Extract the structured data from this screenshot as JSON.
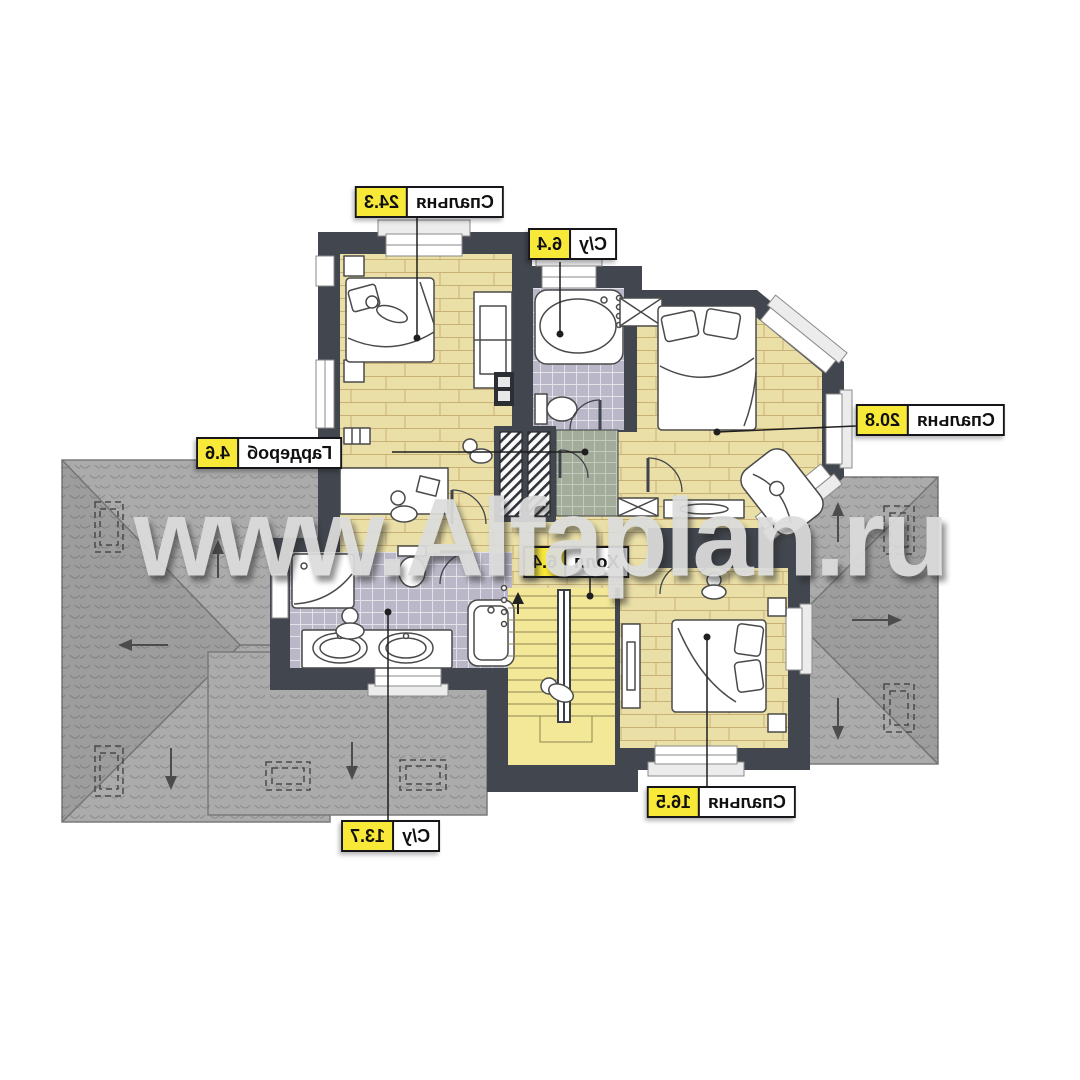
{
  "watermark": {
    "text": "www.Alfaplan.ru"
  },
  "floor_plan": {
    "note": "second floor plan, mirrored room labels",
    "labels": [
      {
        "room": "Спальня",
        "area": "24.3"
      },
      {
        "room": "С/у",
        "area": "6.4"
      },
      {
        "room": "Спальня",
        "area": "20.8"
      },
      {
        "room": "Гардероб",
        "area": "4.6"
      },
      {
        "room": "Холл",
        "area": "6.4"
      },
      {
        "room": "С/у",
        "area": "13.7"
      },
      {
        "room": "Спальня",
        "area": "16.5"
      }
    ],
    "colors": {
      "wall": "#42464e",
      "plank_floor": "#eadfa6",
      "tile_floor": "#bab7c8",
      "green_floor": "#a3ac9a",
      "stairs_floor": "#f3e897",
      "roof": "#ababab",
      "label_yellow": "#f8e838",
      "watermark_gray": "#dcdcdc"
    }
  }
}
